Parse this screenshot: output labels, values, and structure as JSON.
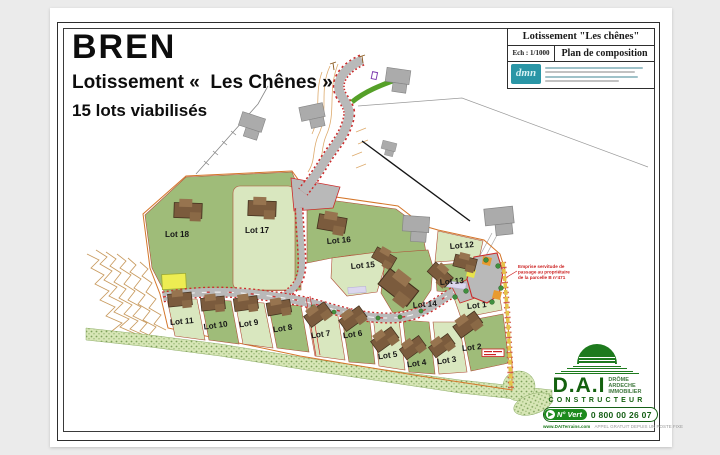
{
  "header": {
    "city": "BREN",
    "subtitle": "Lotissement «  Les Chênes »",
    "lots_line": "15 lots viabilisés"
  },
  "cartouche": {
    "title": "Lotissement \"Les chênes\"",
    "scale": "Ech : 1/1000",
    "plan": "Plan de composition",
    "logo_text": "dmn"
  },
  "map": {
    "lot_labels": [
      "Lot 1",
      "Lot 2",
      "Lot 3",
      "Lot 4",
      "Lot 5",
      "Lot 6",
      "Lot 7",
      "Lot 8",
      "Lot 9",
      "Lot 10",
      "Lot 11",
      "Lot 12",
      "Lot 13",
      "Lot 14",
      "Lot 15",
      "Lot 16",
      "Lot 17",
      "Lot 18"
    ],
    "servitude_note": {
      "line1": "Emprise servitude de",
      "line2": "passage au propriétaire",
      "line3": "de la parcelle B n°471"
    }
  },
  "branding": {
    "name": "D.A.I",
    "region": [
      "DRÔME",
      "ARDECHE",
      "IMMOBILIER"
    ],
    "role": "CONSTRUCTEUR",
    "green_number_label": "N° Vert",
    "green_number": "0 800 00 26 07",
    "arrow_glyph": "▶",
    "website": "www.DAITerrains.com",
    "call_note": "APPEL GRATUIT DEPUIS UN POSTE FIXE"
  },
  "colors": {
    "background": "#ebebeb",
    "lot_dark_green": "#9fbc79",
    "lot_pale_green": "#d9e7bf",
    "road_gray": "#b9b9b9",
    "road_edge_red": "#cc2a2a",
    "house_brown": "#7b5b3d",
    "vegetation_green": "#d7e6b6",
    "boundary_orange": "#d4762a",
    "dai_green": "#1d7a1d",
    "cartouche_teal": "#2a96a6"
  }
}
